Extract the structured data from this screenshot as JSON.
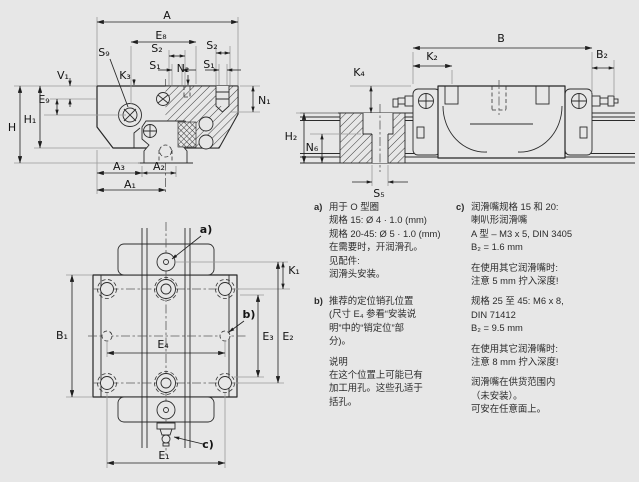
{
  "page": {
    "background": "#e7e7e7",
    "line_color": "#262626",
    "extension_line_color": "#9b9b9b"
  },
  "figure": {
    "views": {
      "cross_section": "front cross-section view of runner block on rail",
      "side": "side view of runner block on rail",
      "plan": "top plan view of runner block"
    }
  },
  "dims": {
    "cross_section": [
      "A",
      "E₈",
      "S₂",
      "S₁",
      "N₂",
      "S₂",
      "S₁",
      "S₉",
      "K₃",
      "V₁",
      "E₉",
      "H",
      "H₁",
      "N₁",
      "A₃",
      "A₂",
      "A₁"
    ],
    "side_view": [
      "B",
      "K₂",
      "B₂",
      "K₄",
      "H₂",
      "N₆",
      "S₅"
    ],
    "top_view": [
      "B₁",
      "E₄",
      "E₁",
      "K₁",
      "E₃",
      "E₂",
      "a)",
      "b)",
      "c)"
    ]
  },
  "notes": {
    "a": {
      "marker": "a)",
      "paragraphs": [
        [
          "用于 O 型圈",
          "规格 15: Ø 4 · 1.0 (mm)",
          "规格 20-45: Ø 5 · 1.0 (mm)",
          "在需要时，开润滑孔。",
          "见配件:",
          "润滑头安装。"
        ]
      ]
    },
    "b": {
      "marker": "b)",
      "paragraphs": [
        [
          "推荐的定位销孔位置",
          "(尺寸 E₄ 参看“安装说",
          "明”中的“销定位”部",
          "分)。"
        ],
        [
          "说明",
          "在这个位置上可能已有",
          "加工用孔。这些孔适于",
          "括孔。"
        ]
      ]
    },
    "c": {
      "marker": "c)",
      "paragraphs": [
        [
          "润滑嘴规格 15 和 20:",
          "喇叭形润滑嘴",
          "A 型 – M3 x 5, DIN 3405",
          "B₂ = 1.6 mm"
        ],
        [
          "在使用其它润滑嘴时:",
          "注意 5 mm 拧入深度!"
        ],
        [
          "规格 25 至 45: M6 x 8,",
          "DIN 71412",
          "B₂ = 9.5 mm"
        ],
        [
          "在使用其它润滑嘴时:",
          "注意 8 mm 拧入深度!"
        ],
        [
          "润滑嘴在供货范围内",
          "（未安装）。",
          "可安在任意面上。"
        ]
      ]
    }
  }
}
